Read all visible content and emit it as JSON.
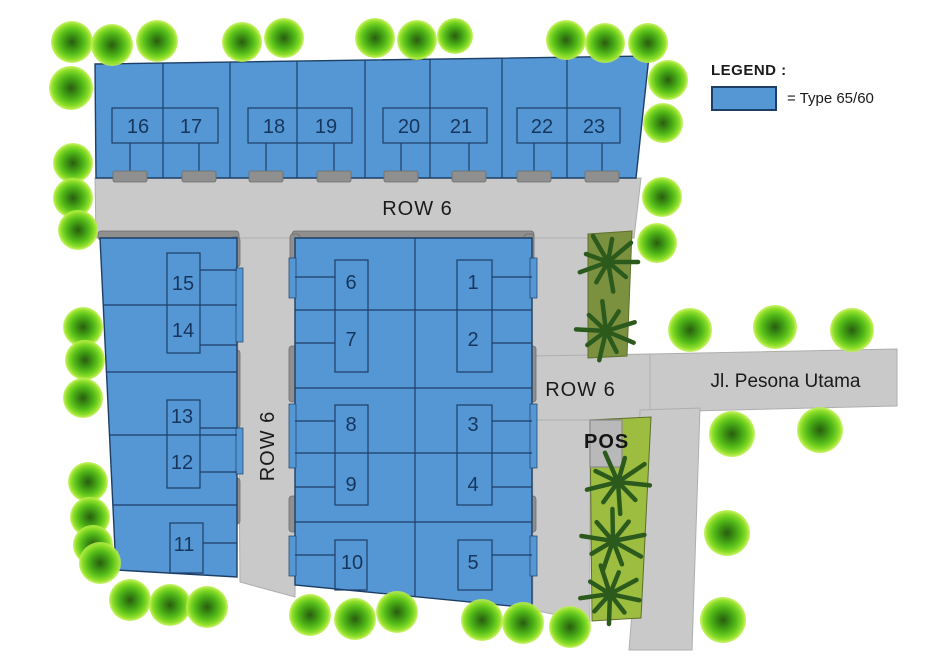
{
  "canvas": {
    "width": 943,
    "height": 666,
    "background": "#ffffff"
  },
  "colors": {
    "road": "#c9c9c9",
    "road_edge": "#aeaeae",
    "lot_fill": "#5596d4",
    "lot_border": "#1d3f66",
    "curb": "#8f8f8f",
    "curb_border": "#6d6d6d",
    "apron": "#8f8f8f",
    "strip_upper": "#7b9140",
    "strip_lower": "#9dbd41",
    "strip_border": "#5c7029",
    "palm": "#2c5a1d",
    "pos_fill": "#b9b9b9",
    "pos_border": "#8a8a8a",
    "number": "#16365d",
    "text": "#1a1a1a"
  },
  "legend": {
    "heading": "LEGEND :",
    "label": "= Type 65/60"
  },
  "labels": {
    "row6_top": "ROW 6",
    "row6_left": "ROW 6",
    "row6_right": "ROW 6",
    "street": "Jl. Pesona Utama",
    "pos": "POS"
  },
  "lot_numbers": [
    {
      "label": "16",
      "x": 138,
      "y": 127
    },
    {
      "label": "17",
      "x": 191,
      "y": 127
    },
    {
      "label": "18",
      "x": 274,
      "y": 127
    },
    {
      "label": "19",
      "x": 326,
      "y": 127
    },
    {
      "label": "20",
      "x": 409,
      "y": 127
    },
    {
      "label": "21",
      "x": 461,
      "y": 127
    },
    {
      "label": "22",
      "x": 542,
      "y": 127
    },
    {
      "label": "23",
      "x": 594,
      "y": 127
    },
    {
      "label": "15",
      "x": 183,
      "y": 284
    },
    {
      "label": "14",
      "x": 183,
      "y": 331
    },
    {
      "label": "13",
      "x": 182,
      "y": 417
    },
    {
      "label": "12",
      "x": 182,
      "y": 463
    },
    {
      "label": "11",
      "x": 184,
      "y": 545
    },
    {
      "label": "6",
      "x": 351,
      "y": 283
    },
    {
      "label": "7",
      "x": 351,
      "y": 340
    },
    {
      "label": "8",
      "x": 351,
      "y": 425
    },
    {
      "label": "9",
      "x": 351,
      "y": 485
    },
    {
      "label": "10",
      "x": 352,
      "y": 563
    },
    {
      "label": "1",
      "x": 473,
      "y": 283
    },
    {
      "label": "2",
      "x": 473,
      "y": 340
    },
    {
      "label": "3",
      "x": 473,
      "y": 425
    },
    {
      "label": "4",
      "x": 473,
      "y": 485
    },
    {
      "label": "5",
      "x": 473,
      "y": 563
    }
  ],
  "geometry": {
    "roads": [
      {
        "name": "road-row6-top",
        "points": "95,178 641,178 634,238 96,238"
      },
      {
        "name": "road-row6-left",
        "points": "237,238 297,238 295,597 240,582"
      },
      {
        "name": "road-row6-right",
        "points": "532,238 590,238 590,622 533,610"
      },
      {
        "name": "road-junction",
        "points": "532,356 650,354 650,420 532,420"
      },
      {
        "name": "road-jl-pesona-utama",
        "points": "650,354 897,349 897,406 650,412"
      },
      {
        "name": "road-far-right",
        "points": "640,410 700,408 692,650 629,650 635,576"
      }
    ],
    "blocks": [
      {
        "name": "block-top-lots-16-23",
        "points": "95,64 649,56 636,178 96,178"
      },
      {
        "name": "block-left-lots-11-15",
        "points": "100,238 237,238 237,577 116,570"
      },
      {
        "name": "block-middle-lots-1-10",
        "points": "295,238 532,238 532,608 295,585"
      }
    ],
    "curbs": [
      [
        98,
        231,
        141,
        9
      ],
      [
        230,
        237,
        10,
        30
      ],
      [
        230,
        350,
        10,
        78
      ],
      [
        230,
        478,
        10,
        46
      ],
      [
        292,
        231,
        242,
        9
      ],
      [
        290,
        234,
        10,
        44
      ],
      [
        524,
        234,
        10,
        44
      ],
      [
        289,
        346,
        10,
        56
      ],
      [
        289,
        496,
        10,
        36
      ],
      [
        526,
        346,
        10,
        56
      ],
      [
        526,
        496,
        10,
        36
      ]
    ],
    "stubs": [
      [
        236,
        268,
        7,
        74
      ],
      [
        236,
        428,
        7,
        46
      ],
      [
        289,
        258,
        7,
        40
      ],
      [
        289,
        404,
        7,
        64
      ],
      [
        289,
        536,
        7,
        40
      ],
      [
        530,
        258,
        7,
        40
      ],
      [
        530,
        404,
        7,
        64
      ],
      [
        530,
        536,
        7,
        40
      ]
    ],
    "lot_lines": [
      [
        163,
        63,
        163,
        178
      ],
      [
        230,
        62,
        230,
        178
      ],
      [
        297,
        61,
        297,
        178
      ],
      [
        365,
        60,
        365,
        178
      ],
      [
        430,
        59,
        430,
        178
      ],
      [
        502,
        58,
        502,
        178
      ],
      [
        567,
        57,
        567,
        178
      ],
      [
        103,
        305,
        237,
        305
      ],
      [
        107,
        372,
        237,
        372
      ],
      [
        110,
        435,
        237,
        435
      ],
      [
        113,
        505,
        237,
        505
      ],
      [
        415,
        238,
        415,
        597
      ],
      [
        295,
        310,
        532,
        310
      ],
      [
        295,
        388,
        532,
        388
      ],
      [
        295,
        453,
        532,
        453
      ],
      [
        295,
        522,
        532,
        522
      ]
    ],
    "house_rects": [
      [
        112,
        108,
        106,
        35
      ],
      [
        248,
        108,
        104,
        35
      ],
      [
        383,
        108,
        104,
        35
      ],
      [
        517,
        108,
        103,
        35
      ],
      [
        167,
        253,
        33,
        100
      ],
      [
        167,
        400,
        33,
        88
      ],
      [
        170,
        523,
        33,
        50
      ],
      [
        335,
        260,
        33,
        112
      ],
      [
        457,
        260,
        35,
        112
      ],
      [
        335,
        405,
        33,
        100
      ],
      [
        457,
        405,
        35,
        100
      ],
      [
        335,
        540,
        32,
        50
      ],
      [
        458,
        540,
        34,
        50
      ]
    ],
    "connectors": [
      [
        130,
        143,
        130,
        178
      ],
      [
        199,
        143,
        199,
        178
      ],
      [
        266,
        143,
        266,
        178
      ],
      [
        334,
        143,
        334,
        178
      ],
      [
        401,
        143,
        401,
        178
      ],
      [
        469,
        143,
        469,
        178
      ],
      [
        534,
        143,
        534,
        178
      ],
      [
        602,
        143,
        602,
        178
      ],
      [
        200,
        270,
        237,
        270
      ],
      [
        200,
        345,
        237,
        345
      ],
      [
        200,
        428,
        237,
        428
      ],
      [
        200,
        472,
        237,
        472
      ],
      [
        203,
        543,
        237,
        543
      ],
      [
        295,
        277,
        335,
        277
      ],
      [
        295,
        343,
        335,
        343
      ],
      [
        295,
        421,
        335,
        421
      ],
      [
        295,
        487,
        335,
        487
      ],
      [
        295,
        555,
        335,
        555
      ],
      [
        492,
        277,
        532,
        277
      ],
      [
        492,
        343,
        532,
        343
      ],
      [
        492,
        421,
        532,
        421
      ],
      [
        492,
        487,
        532,
        487
      ],
      [
        492,
        555,
        532,
        555
      ]
    ],
    "aprons": [
      [
        113,
        171,
        34,
        11
      ],
      [
        182,
        171,
        34,
        11
      ],
      [
        249,
        171,
        34,
        11
      ],
      [
        317,
        171,
        34,
        11
      ],
      [
        384,
        171,
        34,
        11
      ],
      [
        452,
        171,
        34,
        11
      ],
      [
        517,
        171,
        34,
        11
      ],
      [
        585,
        171,
        34,
        11
      ]
    ],
    "strips": [
      {
        "name": "green-strip-upper",
        "points": "588,234 632,231 627,356 588,358",
        "fill": "strip_upper"
      },
      {
        "name": "green-strip-lower",
        "points": "590,420 651,417 641,618 592,621",
        "fill": "strip_lower"
      }
    ],
    "pos_box": [
      590,
      420,
      32,
      47
    ],
    "palms": [
      [
        608,
        262,
        30
      ],
      [
        606,
        331,
        30
      ],
      [
        618,
        482,
        32
      ],
      [
        613,
        541,
        32
      ],
      [
        610,
        594,
        30
      ]
    ],
    "trees": [
      [
        72,
        42,
        21
      ],
      [
        112,
        45,
        21
      ],
      [
        157,
        41,
        21
      ],
      [
        71,
        88,
        22
      ],
      [
        242,
        42,
        20
      ],
      [
        284,
        38,
        20
      ],
      [
        375,
        38,
        20
      ],
      [
        417,
        40,
        20
      ],
      [
        455,
        36,
        18
      ],
      [
        566,
        40,
        20
      ],
      [
        605,
        43,
        20
      ],
      [
        648,
        43,
        20
      ],
      [
        668,
        80,
        20
      ],
      [
        663,
        123,
        20
      ],
      [
        662,
        197,
        20
      ],
      [
        657,
        243,
        20
      ],
      [
        73,
        163,
        20
      ],
      [
        73,
        198,
        20
      ],
      [
        78,
        230,
        20
      ],
      [
        83,
        327,
        20
      ],
      [
        85,
        360,
        20
      ],
      [
        83,
        398,
        20
      ],
      [
        88,
        482,
        20
      ],
      [
        90,
        517,
        20
      ],
      [
        93,
        545,
        20
      ],
      [
        100,
        563,
        21
      ],
      [
        130,
        600,
        21
      ],
      [
        170,
        605,
        21
      ],
      [
        207,
        607,
        21
      ],
      [
        310,
        615,
        21
      ],
      [
        355,
        619,
        21
      ],
      [
        397,
        612,
        21
      ],
      [
        482,
        620,
        21
      ],
      [
        523,
        623,
        21
      ],
      [
        570,
        627,
        21
      ],
      [
        690,
        330,
        22
      ],
      [
        775,
        327,
        22
      ],
      [
        852,
        330,
        22
      ],
      [
        732,
        434,
        23
      ],
      [
        820,
        430,
        23
      ],
      [
        727,
        533,
        23
      ],
      [
        723,
        620,
        23
      ]
    ]
  }
}
